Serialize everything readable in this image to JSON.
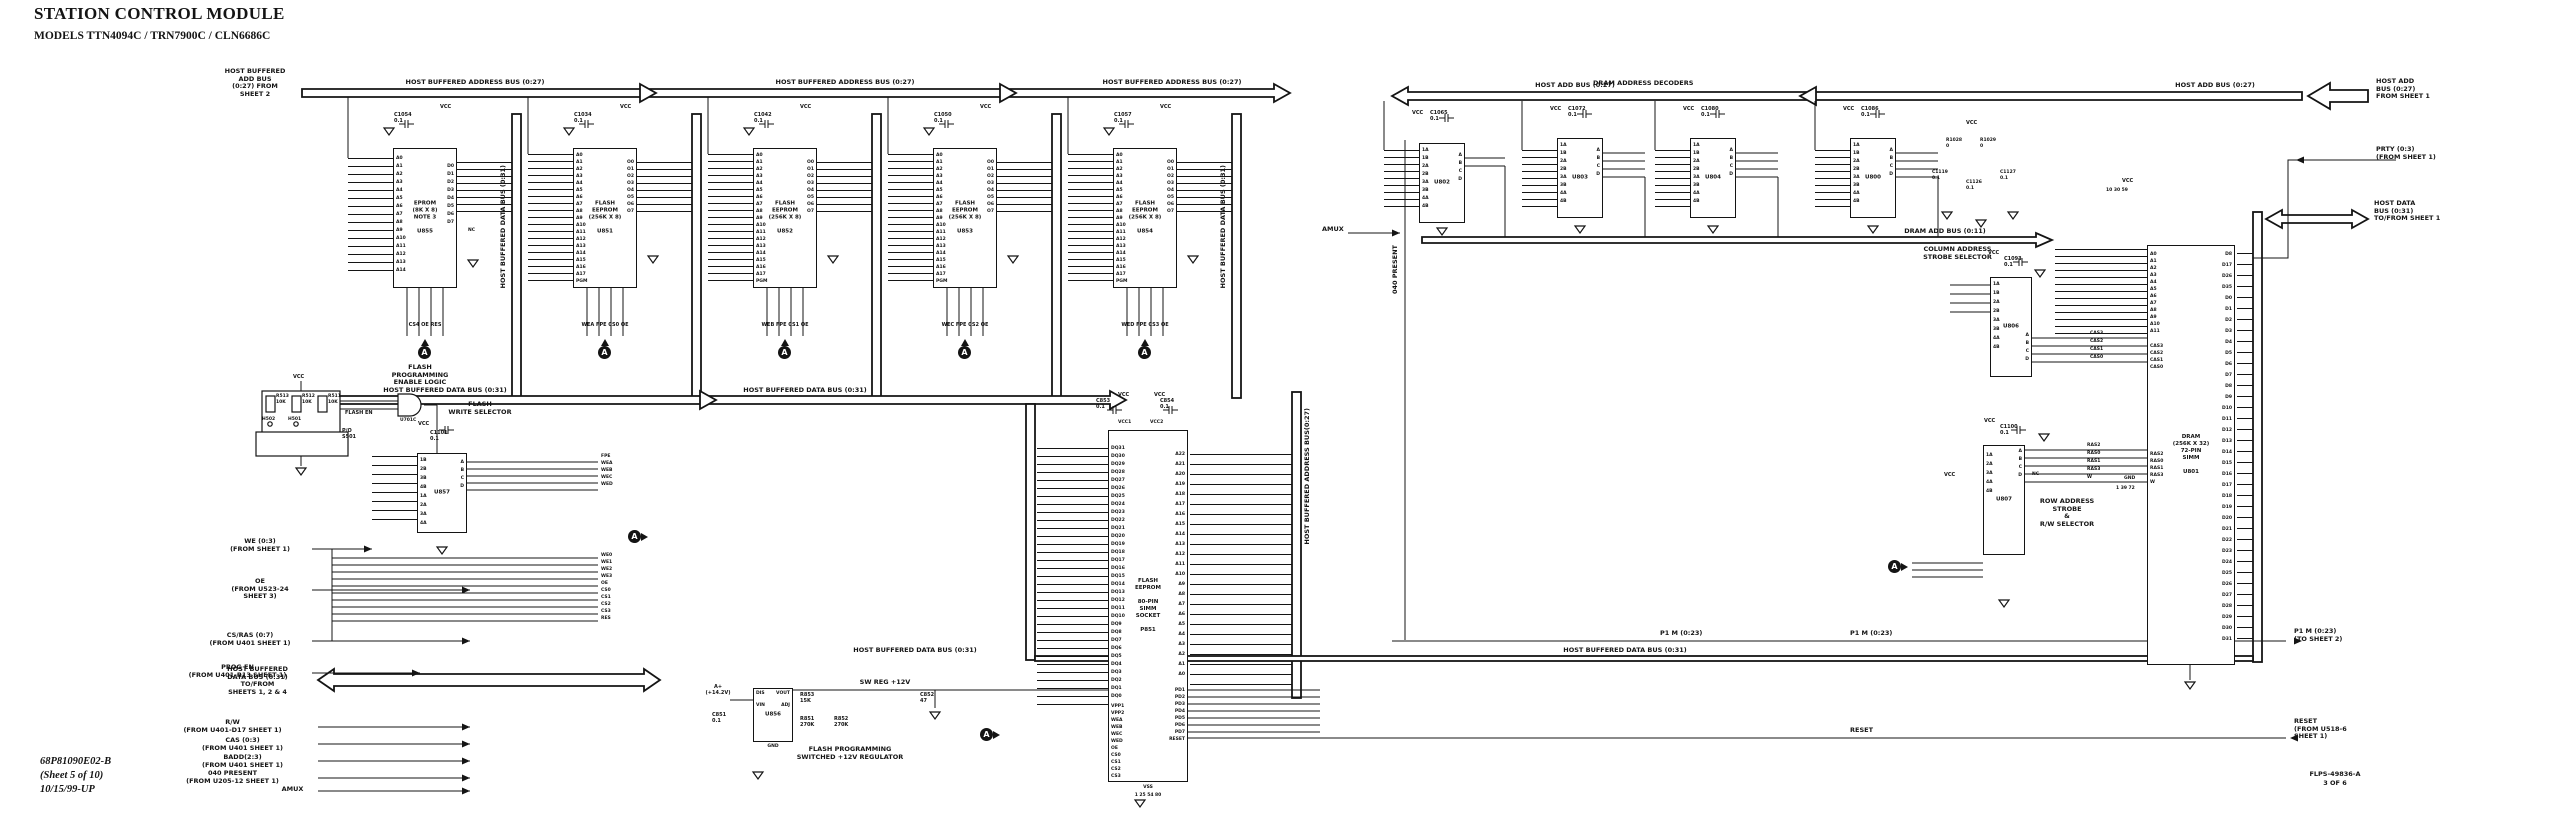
{
  "meta": {
    "title": "STATION CONTROL MODULE",
    "subtitle": "MODELS TTN4094C / TRN7900C / CLN6686C",
    "doc_number": "68P81090E02-B",
    "sheet": "(Sheet 5 of 10)",
    "revision": "10/15/99-UP",
    "drawing_ref": "FLPS-49836-A",
    "drawing_page": "3 OF 6",
    "ink": "#141414",
    "background": "#ffffff"
  },
  "buses": {
    "hb_addr": "HOST BUFFERED ADDRESS BUS (0:27)",
    "hb_data": "HOST BUFFERED DATA BUS (0:31)",
    "hb_data_v": "HOST BUFFERED DATA BUS (0:31)",
    "hb_addr_v": "HOST BUFFERED ADDRESS BUS(0:27)",
    "host_add": "HOST ADD BUS (0:27)",
    "dram_add": "DRAM ADD BUS (0:11)",
    "sw_reg": "SW REG +12V"
  },
  "sections": {
    "dram_decoders": "DRAM ADDRESS DECODERS",
    "flash_prog_enable": "FLASH\nPROGRAMMING\nENABLE LOGIC",
    "flash_write_sel": "FLASH\nWRITE SELECTOR",
    "col_addr": "COLUMN ADDRESS\nSTROBE SELECTOR",
    "row_addr": "ROW ADDRESS\nSTROBE\n&\nR/W SELECTOR",
    "vpp_reg": "FLASH PROGRAMMING\nSWITCHED +12V REGULATOR"
  },
  "flags": {
    "left_add_bus": "HOST BUFFERED\nADD BUS\n(0:27) FROM\nSHEET 2",
    "we03": "WE (0:3)\n(FROM SHEET 1)",
    "oe": "OE\n(FROM U523-24\nSHEET 3)",
    "cs_ras": "CS/RAS (0:7)\n(FROM U401 SHEET 1)",
    "prog_en": "PROG EN\n(FROM U401-R13 SHEET 1)",
    "hbdb": "HOST BUFFERED\nDATA BUS (0:31)\nTO/FROM\nSHEETS 1, 2 & 4",
    "rw": "R/W\n(FROM U401-D17 SHEET 1)",
    "cas03": "CAS (0:3)\n(FROM U401 SHEET 1)",
    "badd": "BADD(2:3)\n(FROM U401 SHEET 1)",
    "present040": "040 PRESENT\n(FROM U205-12 SHEET 1)",
    "amux": "AMUX",
    "host_add_right": "HOST ADD\nBUS (0:27)\nFROM SHEET 1",
    "prty": "PRTY (0:3)\n(FROM SHEET 1)",
    "host_data_right": "HOST DATA\nBUS (0:31)\nTO/FROM SHEET 1",
    "p1m_right": "P1 M (0:23)\n(TO SHEET 2)",
    "reset_right": "RESET\n(FROM U518-6\nSHEET 1)",
    "present040_v": "040 PRESENT",
    "p1m": "P1 M (0:23)",
    "reset": "RESET",
    "a_plus": "A+\n(+14.2V)",
    "flash_en": "FLASH EN",
    "po_s501": "P/O\nS501",
    "vss": "VSS"
  },
  "symbols": {
    "vcc": "VCC",
    "nc": "NC",
    "bundle": "A",
    "gnd": "GND"
  },
  "signals": {
    "u857_out": [
      "FPE",
      "WEA",
      "WEB",
      "WEC",
      "WED"
    ],
    "mid": [
      "WE0",
      "WE1",
      "WE2",
      "WE3",
      "OE",
      "CS0",
      "CS1",
      "CS2",
      "CS3",
      "RES"
    ],
    "cas": [
      "CAS3",
      "CAS2",
      "CAS1",
      "CAS0"
    ],
    "ras": [
      "RAS2",
      "RAS0",
      "RAS1",
      "RAS3",
      "W"
    ]
  },
  "components": {
    "c1054": "C1054\n0.1",
    "c1034": "C1034\n0.1",
    "c1042": "C1042\n0.1",
    "c1050": "C1050\n0.1",
    "c1057": "C1057\n0.1",
    "c1065": "C1065\n0.1",
    "c1072": "C1072\n0.1",
    "c1080": "C1080\n0.1",
    "c1086": "C1086\n0.1",
    "c1093": "C1093\n0.1",
    "c1100": "C1100\n0.1",
    "c1101": "C1101\n0.1",
    "c851": "C851\n0.1",
    "c852": "C852\n47",
    "c853": "C853\n0.1",
    "c854": "C854\n0.1",
    "c1119": "C1119\n0.1",
    "c1126": "C1126\n0.1",
    "c1127": "C1127\n0.1",
    "r511": "R511\n10K",
    "r512": "R512\n10K",
    "r513": "R513\n10K",
    "r851": "R851\n270K",
    "r852": "R852\n270K",
    "r853": "R853\n15K",
    "r1028": "R1028\n0",
    "r1029": "R1029\n0",
    "h501": "H501",
    "h502": "H502",
    "u701c": "U701C",
    "vcc1": "VCC1",
    "vcc2": "VCC2"
  },
  "pinsets": {
    "a014": [
      "A0",
      "A1",
      "A2",
      "A3",
      "A4",
      "A5",
      "A6",
      "A7",
      "A8",
      "A9",
      "A10",
      "A11",
      "A12",
      "A13",
      "A14"
    ],
    "d07": [
      "D0",
      "D1",
      "D2",
      "D3",
      "D4",
      "D5",
      "D6",
      "D7"
    ],
    "flash_left": [
      "A0",
      "A1",
      "A2",
      "A3",
      "A4",
      "A5",
      "A6",
      "A7",
      "A8",
      "A9",
      "A10",
      "A11",
      "A12",
      "A13",
      "A14",
      "A15",
      "A16",
      "A17",
      "PGM"
    ],
    "o07": [
      "O0",
      "O1",
      "O2",
      "O3",
      "O4",
      "O5",
      "O6",
      "O7"
    ],
    "mux_left": [
      "1A",
      "1B",
      "2A",
      "2B",
      "3A",
      "3B",
      "4A",
      "4B"
    ],
    "abcd": [
      "A",
      "B",
      "C",
      "D"
    ]
  },
  "chips": {
    "u855": {
      "text": "EPROM\n(8K X 8)\nNOTE 3\n\nU855",
      "bottom": "CS4  OE  RES"
    },
    "u851": {
      "text": "FLASH\nEEPROM\n(256K X 8)\n\nU851",
      "bottom": "WEA FPE CS0 OE"
    },
    "u852": {
      "text": "FLASH\nEEPROM\n(256K X 8)\n\nU852",
      "bottom": "WEB FPE CS1 OE"
    },
    "u853": {
      "text": "FLASH\nEEPROM\n(256K X 8)\n\nU853",
      "bottom": "WEC FPE CS2 OE"
    },
    "u854": {
      "text": "FLASH\nEEPROM\n(256K X 8)\n\nU854",
      "bottom": "WED FPE CS3 OE"
    },
    "u857": {
      "ref": "U857",
      "left": [
        "1B",
        "2B",
        "3B",
        "4B",
        "1A",
        "2A",
        "3A",
        "4A"
      ]
    },
    "u856": {
      "ref": "U856",
      "left": [
        "DIS",
        "VIN"
      ],
      "right": [
        "VOUT",
        "ADJ"
      ],
      "bottom": "GND"
    },
    "p851": {
      "text": "FLASH\nEEPROM\n\n80-PIN\nSIMM\nSOCKET\n\nP851",
      "left": [
        "DQ31",
        "DQ30",
        "DQ29",
        "DQ28",
        "DQ27",
        "DQ26",
        "DQ25",
        "DQ24",
        "DQ23",
        "DQ22",
        "DQ21",
        "DQ20",
        "DQ19",
        "DQ18",
        "DQ17",
        "DQ16",
        "DQ15",
        "DQ14",
        "DQ13",
        "DQ12",
        "DQ11",
        "DQ10",
        "DQ9",
        "DQ8",
        "DQ7",
        "DQ6",
        "DQ5",
        "DQ4",
        "DQ3",
        "DQ2",
        "DQ1",
        "DQ0"
      ],
      "right": [
        "A22",
        "A21",
        "A20",
        "A19",
        "A18",
        "A17",
        "A16",
        "A15",
        "A14",
        "A13",
        "A12",
        "A11",
        "A10",
        "A9",
        "A8",
        "A7",
        "A6",
        "A5",
        "A4",
        "A3",
        "A2",
        "A1",
        "A0"
      ],
      "right2": [
        "PD1",
        "PD2",
        "PD3",
        "PD4",
        "PD5",
        "PD6",
        "PD7",
        "RESET"
      ],
      "ctrl": [
        "VPP1",
        "VPP2",
        "WEA",
        "WEB",
        "WEC",
        "WED",
        "OE",
        "CS0",
        "CS1",
        "CS2",
        "CS3"
      ],
      "vss_pins": "1   25   54   80"
    },
    "u802": {
      "ref": "U802"
    },
    "u803": {
      "ref": "U803"
    },
    "u804": {
      "ref": "U804"
    },
    "u800": {
      "ref": "U800"
    },
    "u806": {
      "ref": "U806"
    },
    "u807": {
      "ref": "U807",
      "left": [
        "1A",
        "2A",
        "3A",
        "4A",
        "4B"
      ]
    },
    "u801": {
      "text": "DRAM\n(256K X 32)\n72-PIN\nSIMM\n\nU801",
      "addr": [
        "A0",
        "A1",
        "A2",
        "A3",
        "A4",
        "A5",
        "A6",
        "A7",
        "A8",
        "A9",
        "A10",
        "A11"
      ],
      "cas": [
        "CAS3",
        "CAS2",
        "CAS1",
        "CAS0"
      ],
      "ras": [
        "RAS2",
        "RAS0",
        "RAS1",
        "RAS3",
        "W"
      ],
      "data": [
        "D8",
        "D17",
        "D26",
        "D35",
        "D0",
        "D1",
        "D2",
        "D3",
        "D4",
        "D5",
        "D6",
        "D7",
        "D8",
        "D9",
        "D10",
        "D11",
        "D12",
        "D13",
        "D14",
        "D15",
        "D16",
        "D17",
        "D18",
        "D19",
        "D20",
        "D21",
        "D22",
        "D23",
        "D24",
        "D25",
        "D26",
        "D27",
        "D28",
        "D29",
        "D30",
        "D31"
      ],
      "vcc_pins": "10  30  59",
      "gnd_pins": "1  39  72"
    }
  }
}
